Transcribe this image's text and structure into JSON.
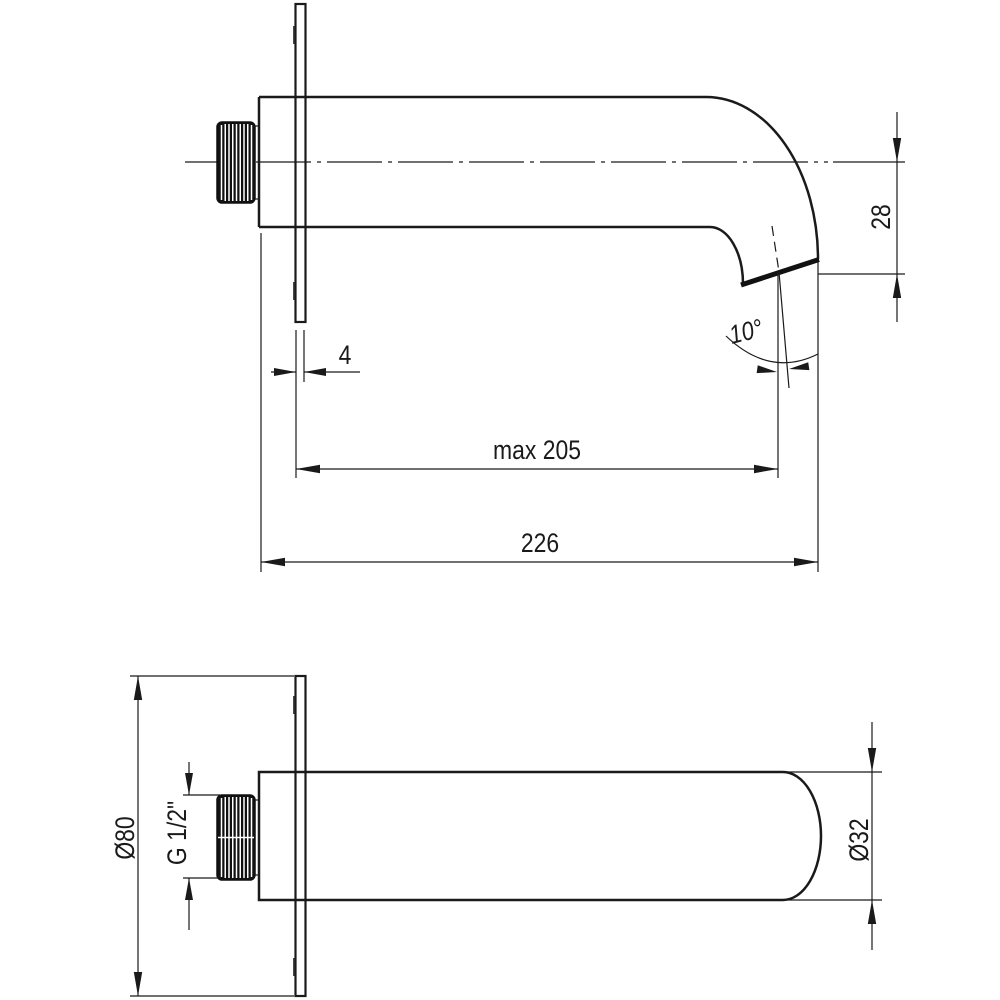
{
  "drawing": {
    "background": "#ffffff",
    "line_color": "#1a1a1a",
    "views": [
      "side view",
      "plan view"
    ]
  },
  "side_view": {
    "dims": {
      "outlet_height": "28",
      "plate_thickness": "4",
      "max_projection": "max 205",
      "total_length": "226",
      "outlet_angle": "10°"
    }
  },
  "plan_view": {
    "dims": {
      "flange_diameter": "Ø80",
      "thread_size": "G 1/2\"",
      "spout_diameter": "Ø32"
    }
  }
}
